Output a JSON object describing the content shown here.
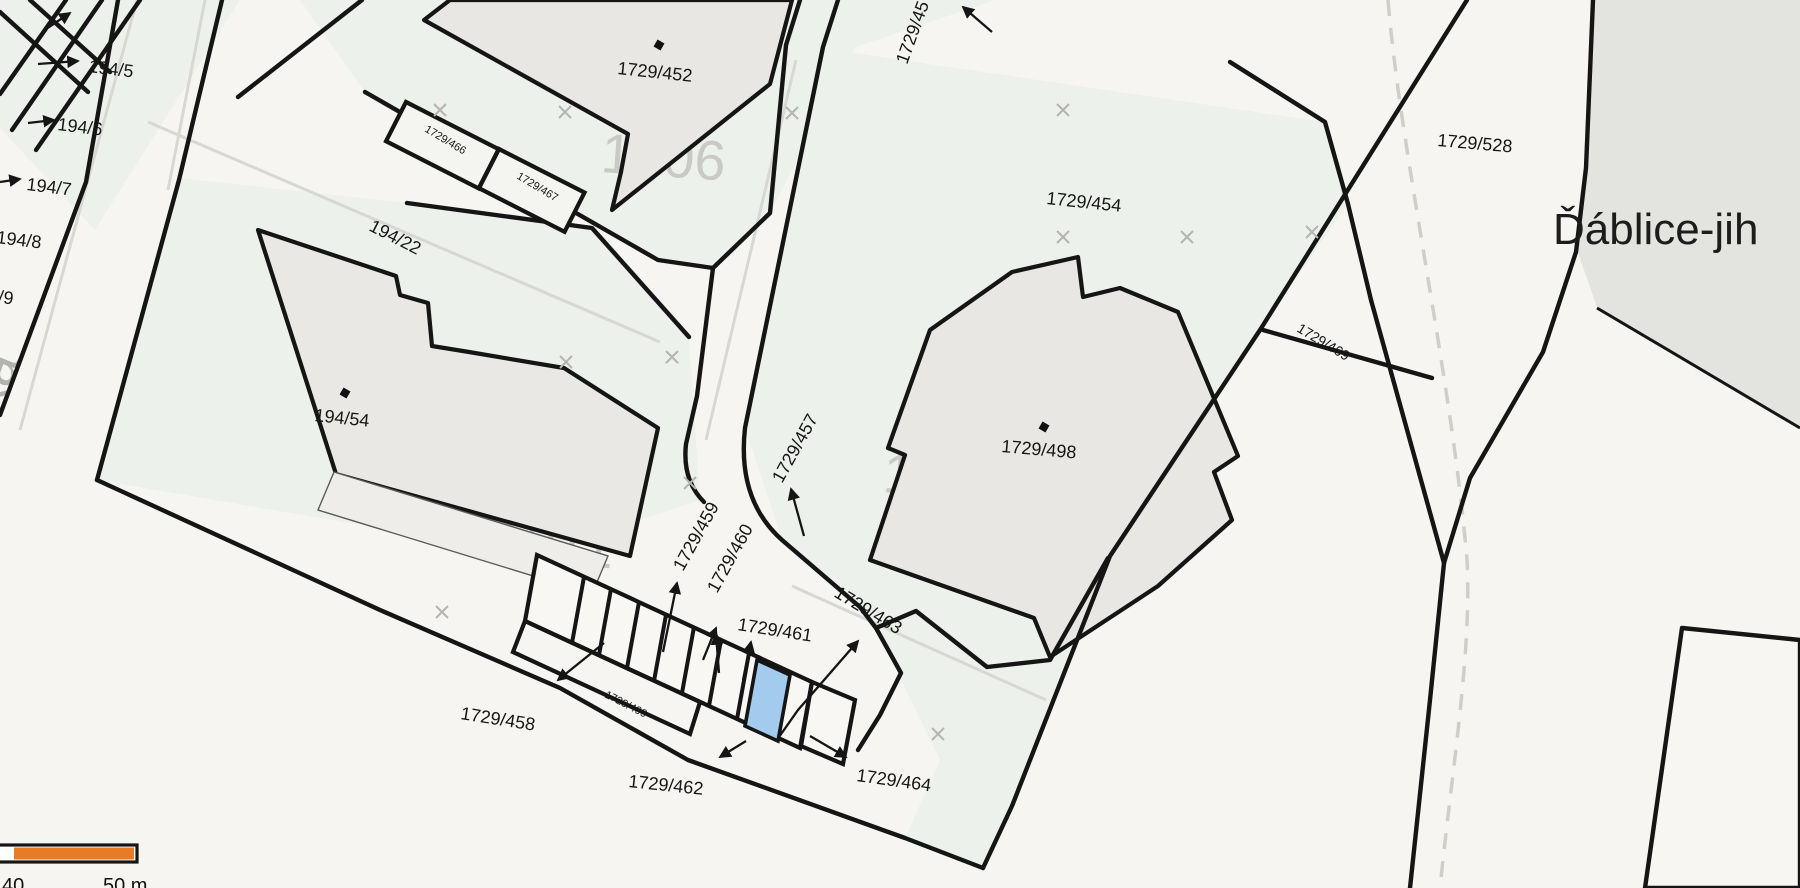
{
  "map": {
    "area_name": "Ďáblice-jih",
    "street_name": "Ďáblická",
    "blocks": {
      "b1006": "1006",
      "b1011": "1011",
      "b1033": "1033"
    },
    "parcels": {
      "p194_5": "194/5",
      "p194_6": "194/6",
      "p194_7": "194/7",
      "p194_8": "194/8",
      "p194_9": "194/9",
      "p194_22": "194/22",
      "p194_54": "194/54",
      "p1729_452": "1729/452",
      "p1729_454": "1729/454",
      "p1729_45x": "1729/45",
      "p1729_457": "1729/457",
      "p1729_458": "1729/458",
      "p1729_459": "1729/459",
      "p1729_460": "1729/460",
      "p1729_461": "1729/461",
      "p1729_462": "1729/462",
      "p1729_463": "1729/463",
      "p1729_464": "1729/464",
      "p1729_466": "1729/466",
      "p1729_467": "1729/467",
      "p1729_469": "1729/469",
      "p1729_498": "1729/498",
      "p1729_499": "1729/499",
      "p1729_528": "1729/528"
    },
    "highlight": {
      "color": "#a3cbee",
      "description": "selected parcel"
    },
    "scale_bar": {
      "tick_40": "40",
      "tick_50": "50 m",
      "bar_color": "#e87c26"
    }
  }
}
